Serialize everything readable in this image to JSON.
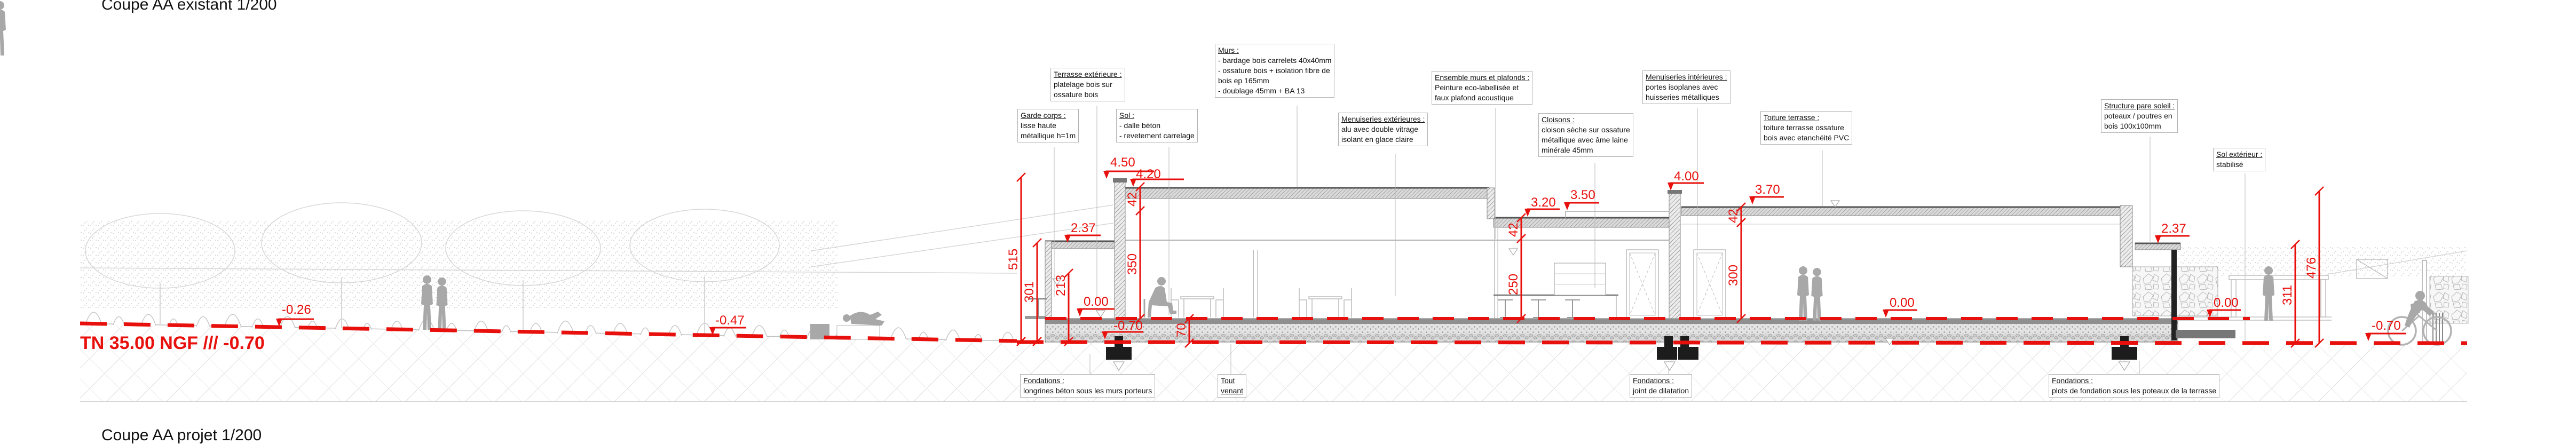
{
  "titles": {
    "top": "Coupe AA existant 1/200",
    "bottom": "Coupe AA projet 1/200"
  },
  "terrain": {
    "label": "TN 35.00 NGF /// -0.70"
  },
  "colors": {
    "dimension_red": "#e8100c",
    "drawing_gray": "#9b9b9b",
    "silhouette_gray": "#a8a8a8"
  },
  "annotations": {
    "terrasse_ext": {
      "title": "Terrasse extérieure :",
      "l1": "platelage bois sur",
      "l2": "ossature bois"
    },
    "garde_corps": {
      "title": "Garde corps :",
      "l1": "lisse haute",
      "l2": "métallique h=1m"
    },
    "sol": {
      "title": "Sol :",
      "l1": "- dalle béton",
      "l2": "- revetement carrelage"
    },
    "murs": {
      "title": "Murs :",
      "l1": "- bardage bois carrelets 40x40mm",
      "l2": "- ossature bois + isolation fibre de",
      "l3": "bois ep 165mm",
      "l4": "- doublage 45mm + BA 13"
    },
    "menuiseries_ext": {
      "title": "Menuiseries extérieures :",
      "l1": "alu avec double vitrage",
      "l2": "isolant en glace claire"
    },
    "ensemble_murs_plafonds": {
      "title": "Ensemble murs et plafonds :",
      "l1": "Peinture eco-labellisée et",
      "l2": "faux plafond acoustique"
    },
    "cloisons": {
      "title": "Cloisons :",
      "l1": "cloison sèche sur ossature",
      "l2": "métallique avec âme laine",
      "l3": "minérale 45mm"
    },
    "menuiseries_int": {
      "title": "Menuiseries intérieures :",
      "l1": "portes isoplanes avec",
      "l2": "huisseries métalliques"
    },
    "toiture_terrasse": {
      "title": "Toiture terrasse :",
      "l1": "toiture terrasse ossature",
      "l2": "bois avec etanchéité PVC"
    },
    "pare_soleil": {
      "title": "Structure pare soleil :",
      "l1": "poteaux / poutres en",
      "l2": "bois 100x100mm"
    },
    "sol_exterieur": {
      "title": "Sol extérieur :",
      "l1": "stabilisé"
    },
    "fondations_longrines": {
      "title": "Fondations :",
      "l1": "longrines béton sous les murs porteurs"
    },
    "tout_venant": {
      "l1": "Tout",
      "l2": "venant"
    },
    "fondations_joint": {
      "title": "Fondations :",
      "l1": "joint de dilatation"
    },
    "fondations_plots": {
      "title": "Fondations :",
      "l1": "plots de fondation sous les poteaux de la terrasse"
    }
  },
  "dimensions": {
    "d450": "4.50",
    "d420": "4.20",
    "d237_left": "2.37",
    "d000_left": "0.00",
    "d070_left": "-0.70",
    "d320": "3.20",
    "d350": "3.50",
    "d400": "4.00",
    "d370": "3.70",
    "d000_mid": "0.00",
    "d237_right": "2.37",
    "d000_right": "0.00",
    "d070_right": "-0.70",
    "d026": "-0.26",
    "d047": "-0.47",
    "v515": "515",
    "v301": "301",
    "v213": "213",
    "v350": "350",
    "v250": "250",
    "v300": "300",
    "v311": "311",
    "v476": "476",
    "v70": "70",
    "v42_left": "42",
    "v42_mid": "42",
    "v42_right": "42"
  }
}
